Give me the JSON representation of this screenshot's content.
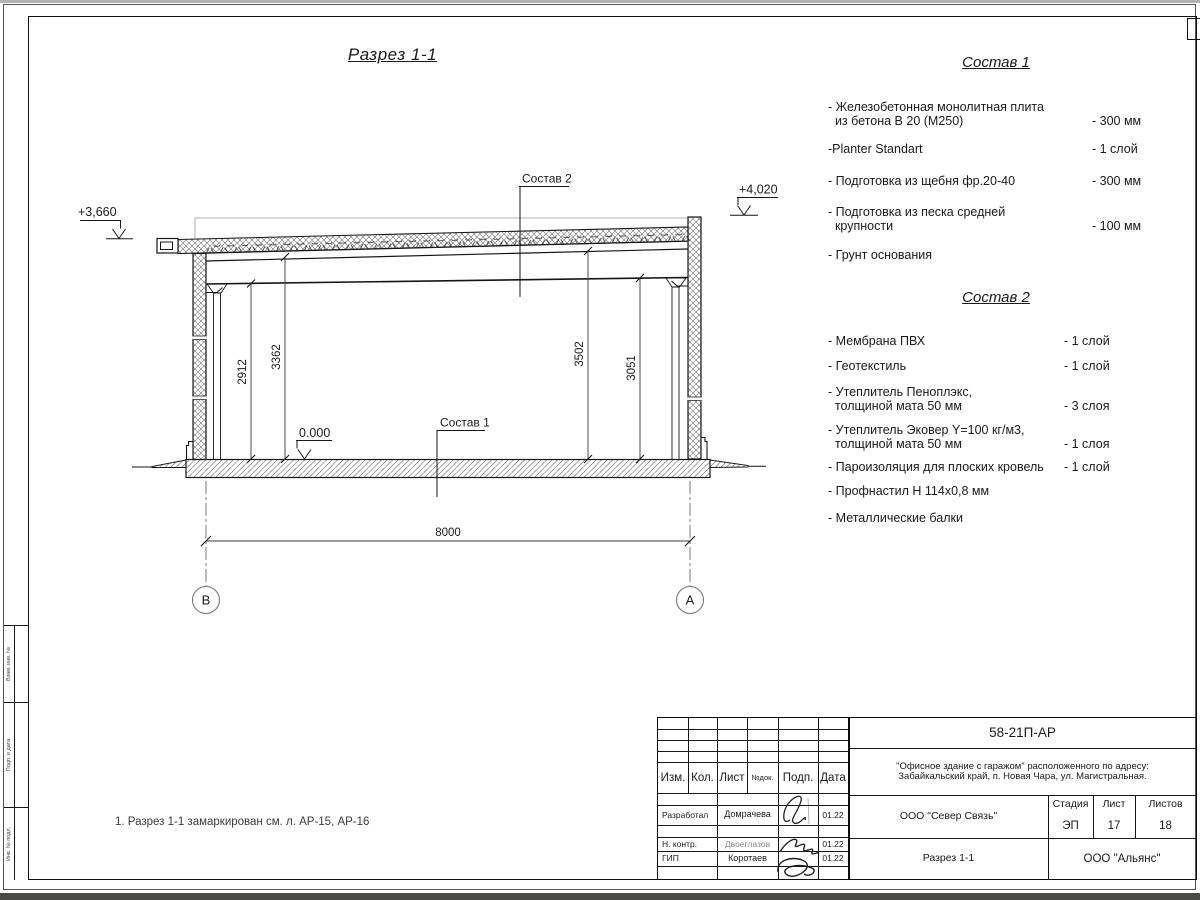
{
  "page": {
    "note": "1. Разрез 1-1 замаркирован см. л. АР-15, АР-16"
  },
  "drawing": {
    "title": "Разрез 1-1",
    "axis_left": "В",
    "axis_right": "А",
    "dim_span": "8000",
    "dim_left_inner": "2912",
    "dim_left_outer": "3362",
    "dim_right_outer": "3502",
    "dim_right_inner": "3051",
    "elev_left": "+3,660",
    "elev_right": "+4,020",
    "elev_floor": "0.000",
    "callout_roof": "Состав 2",
    "callout_floor": "Состав 1"
  },
  "sostav1": {
    "title": "Состав 1",
    "items": [
      {
        "label": "- Железобетонная  монолитная плита\n  из бетона В 20 (М250)",
        "value": "- 300 мм"
      },
      {
        "label": "-Planter Standart",
        "value": "- 1 слой"
      },
      {
        "label": "- Подготовка из щебня фр.20-40",
        "value": "- 300 мм"
      },
      {
        "label": "- Подготовка из песка средней\n  крупности",
        "value": "- 100 мм"
      },
      {
        "label": "- Грунт основания",
        "value": ""
      }
    ]
  },
  "sostav2": {
    "title": "Состав 2",
    "items": [
      {
        "label": "- Мембрана ПВХ",
        "value": "- 1 слой"
      },
      {
        "label": "- Геотекстиль",
        "value": "- 1 слой"
      },
      {
        "label": "- Утеплитель Пеноплэкс,\n  толщиной мата 50 мм",
        "value": "- 3  слоя"
      },
      {
        "label": "- Утеплитель Эковер Y=100 кг/м3,\n  толщиной мата 50 мм",
        "value": "- 1 слоя"
      },
      {
        "label": "- Пароизоляция для плоских кровель",
        "value": "- 1 слой"
      },
      {
        "label": "- Профнастил Н 114х0,8 мм",
        "value": ""
      },
      {
        "label": "- Металлические балки",
        "value": ""
      }
    ]
  },
  "titleblock": {
    "doc_code": "58-21П-АР",
    "project_line1": "\"Офисное здание с гаражом\" расположенного по адресу:",
    "project_line2": "Забайкальский край, п. Новая Чара, ул. Магистральная.",
    "contractor": "ООО \"Север Связь\"",
    "sheet_title": "Разрез 1-1",
    "company": "ООО \"Альянс\"",
    "stage_label": "Стадия",
    "sheet_label": "Лист",
    "sheets_label": "Листов",
    "stage": "ЭП",
    "sheet": "17",
    "sheets": "18",
    "col_izm": "Изм.",
    "col_kol": "Кол.",
    "col_list": "Лист",
    "col_doc": "№док.",
    "col_podp": "Подп.",
    "col_data": "Дата",
    "rows": [
      {
        "role": "Разработал",
        "name": "Домрачева",
        "date": "01.22"
      },
      {
        "role": "Н. контр.",
        "name": "Двоеглазов",
        "date": "01.22"
      },
      {
        "role": "ГИП",
        "name": "Коротаев",
        "date": "01.22"
      }
    ]
  },
  "frame": {
    "left_cell_1": "Взам. инв. №",
    "left_cell_2": "Подп. и дата",
    "left_cell_3": "Инв. № подл."
  }
}
